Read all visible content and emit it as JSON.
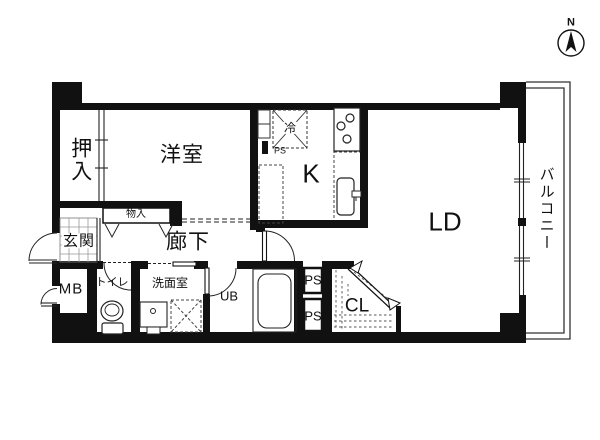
{
  "plan": {
    "type": "apartment-floor-plan",
    "compass": {
      "north_label": "N"
    },
    "labels": {
      "oshiire": "押入",
      "western_room": "洋室",
      "storage": "物入",
      "kitchen": "K",
      "refrigerator": "冷",
      "pipe_space_kitchen": "PS",
      "living_dining": "LD",
      "balcony": "バルコニー",
      "entrance": "玄関",
      "hallway": "廊下",
      "meter_box": "MB",
      "toilet": "トイレ",
      "washroom": "洗面室",
      "unit_bath": "UB",
      "pipe_space_1": "PS",
      "pipe_space_2": "PS",
      "closet": "CL"
    },
    "colors": {
      "wall": "#111111",
      "thin_line": "#222222",
      "hatch_line": "#555555",
      "tile_line": "#999999",
      "background": "#ffffff"
    }
  }
}
